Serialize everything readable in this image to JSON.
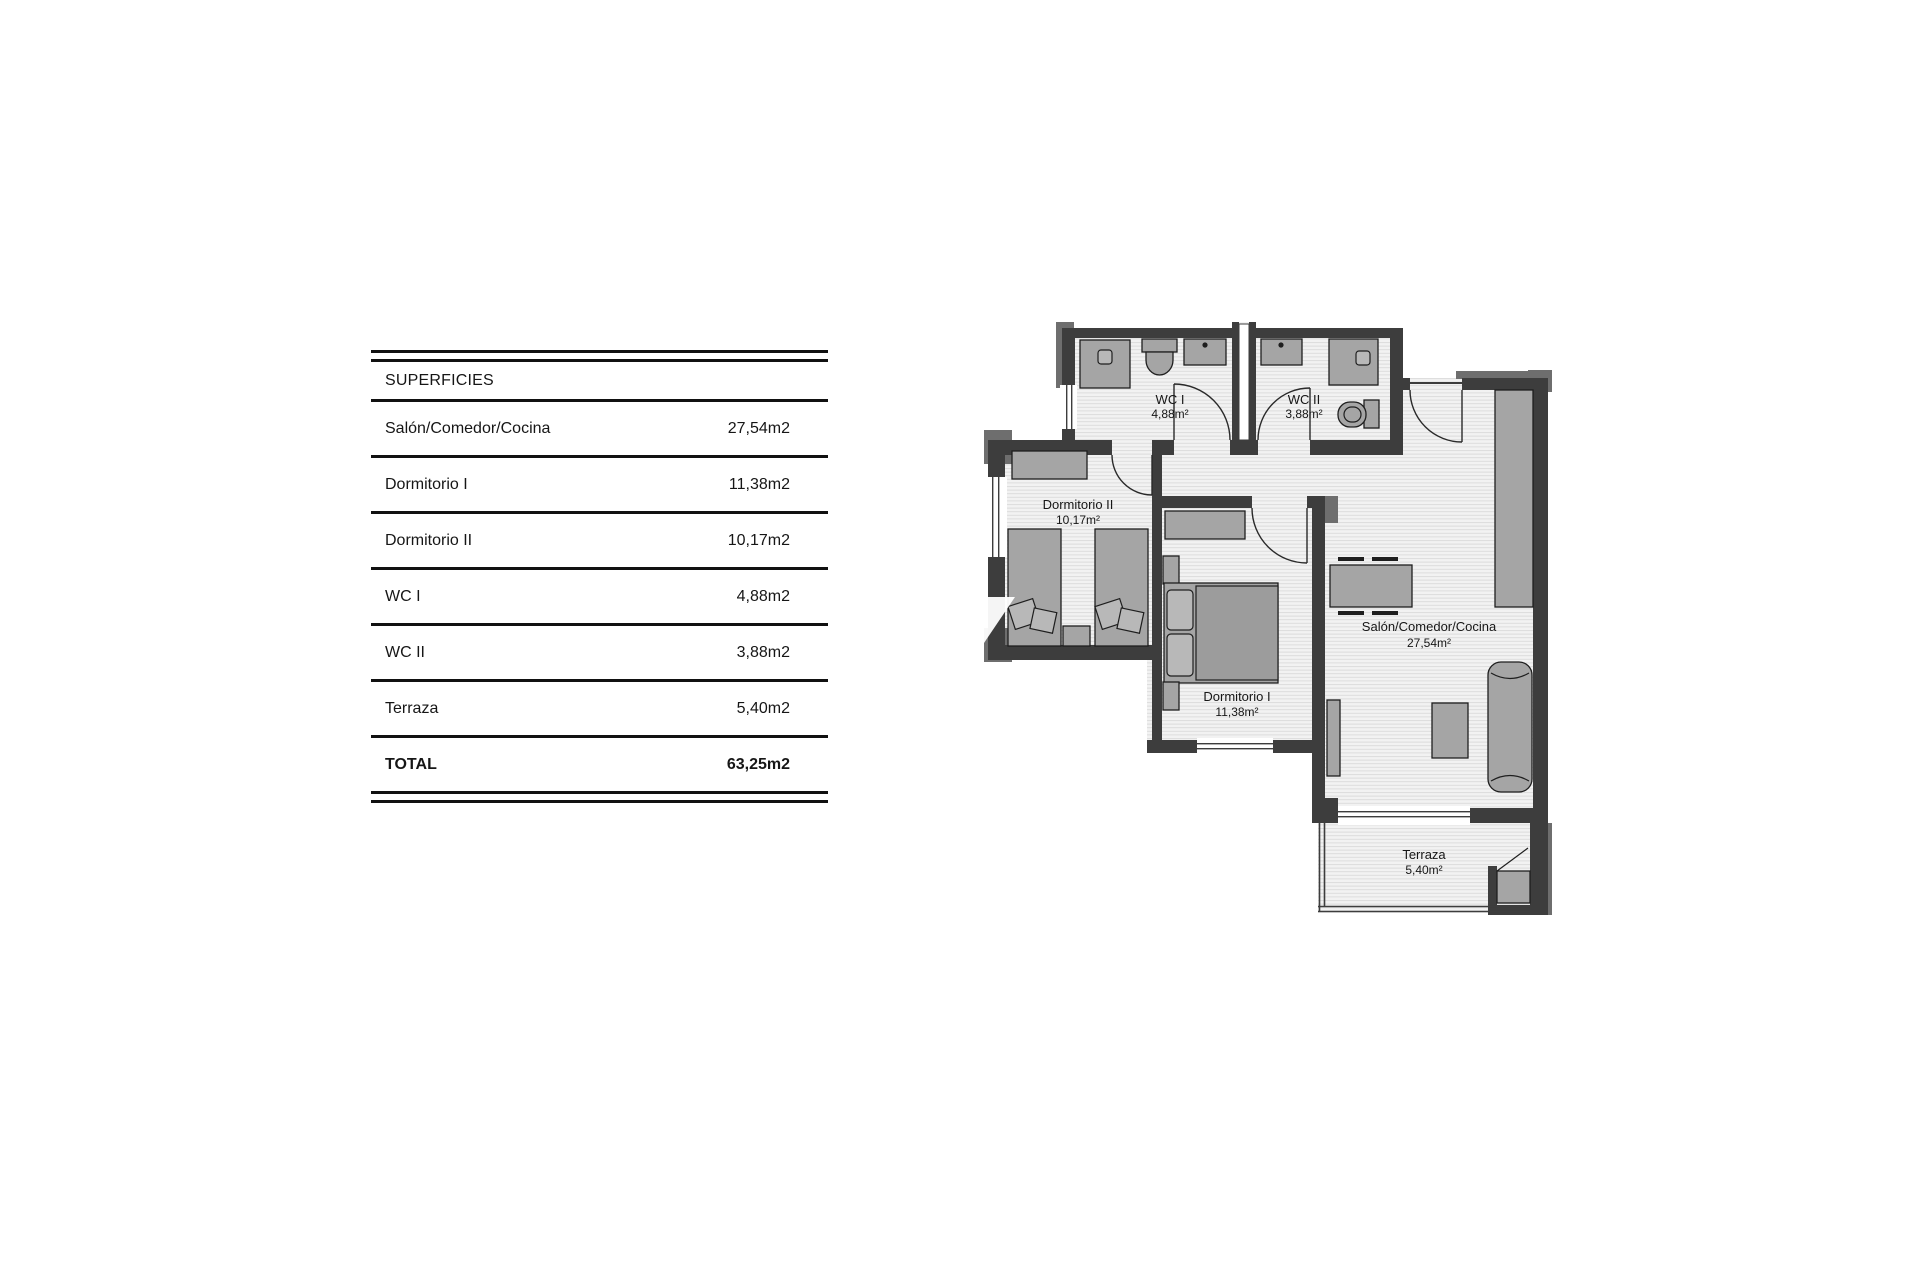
{
  "table": {
    "header": "SUPERFICIES",
    "rows": [
      {
        "label": "Salón/Comedor/Cocina",
        "value": "27,54m2"
      },
      {
        "label": "Dormitorio I",
        "value": "11,38m2"
      },
      {
        "label": "Dormitorio II",
        "value": "10,17m2"
      },
      {
        "label": "WC I",
        "value": "4,88m2"
      },
      {
        "label": "WC II",
        "value": "3,88m2"
      },
      {
        "label": "Terraza",
        "value": "5,40m2"
      }
    ],
    "total": {
      "label": "TOTAL",
      "value": "63,25m2"
    }
  },
  "plan": {
    "rooms": [
      {
        "id": "wc1",
        "name": "WC I",
        "area": "4,88m²"
      },
      {
        "id": "wc2",
        "name": "WC II",
        "area": "3,88m²"
      },
      {
        "id": "dorm2",
        "name": "Dormitorio II",
        "area": "10,17m²"
      },
      {
        "id": "dorm1",
        "name": "Dormitorio I",
        "area": "11,38m²"
      },
      {
        "id": "salon",
        "name": "Salón/Comedor/Cocina",
        "area": "27,54m²"
      },
      {
        "id": "terraza",
        "name": "Terraza",
        "area": "5,40m²"
      }
    ],
    "colors": {
      "wall": "#3d3d3d",
      "wall_trim": "#6e6e6e",
      "furniture": "#a5a5a5",
      "floor": "#f2f2f2",
      "floor_hatch": "#dcdcdc",
      "text": "#161616",
      "rule": "#111111"
    }
  }
}
